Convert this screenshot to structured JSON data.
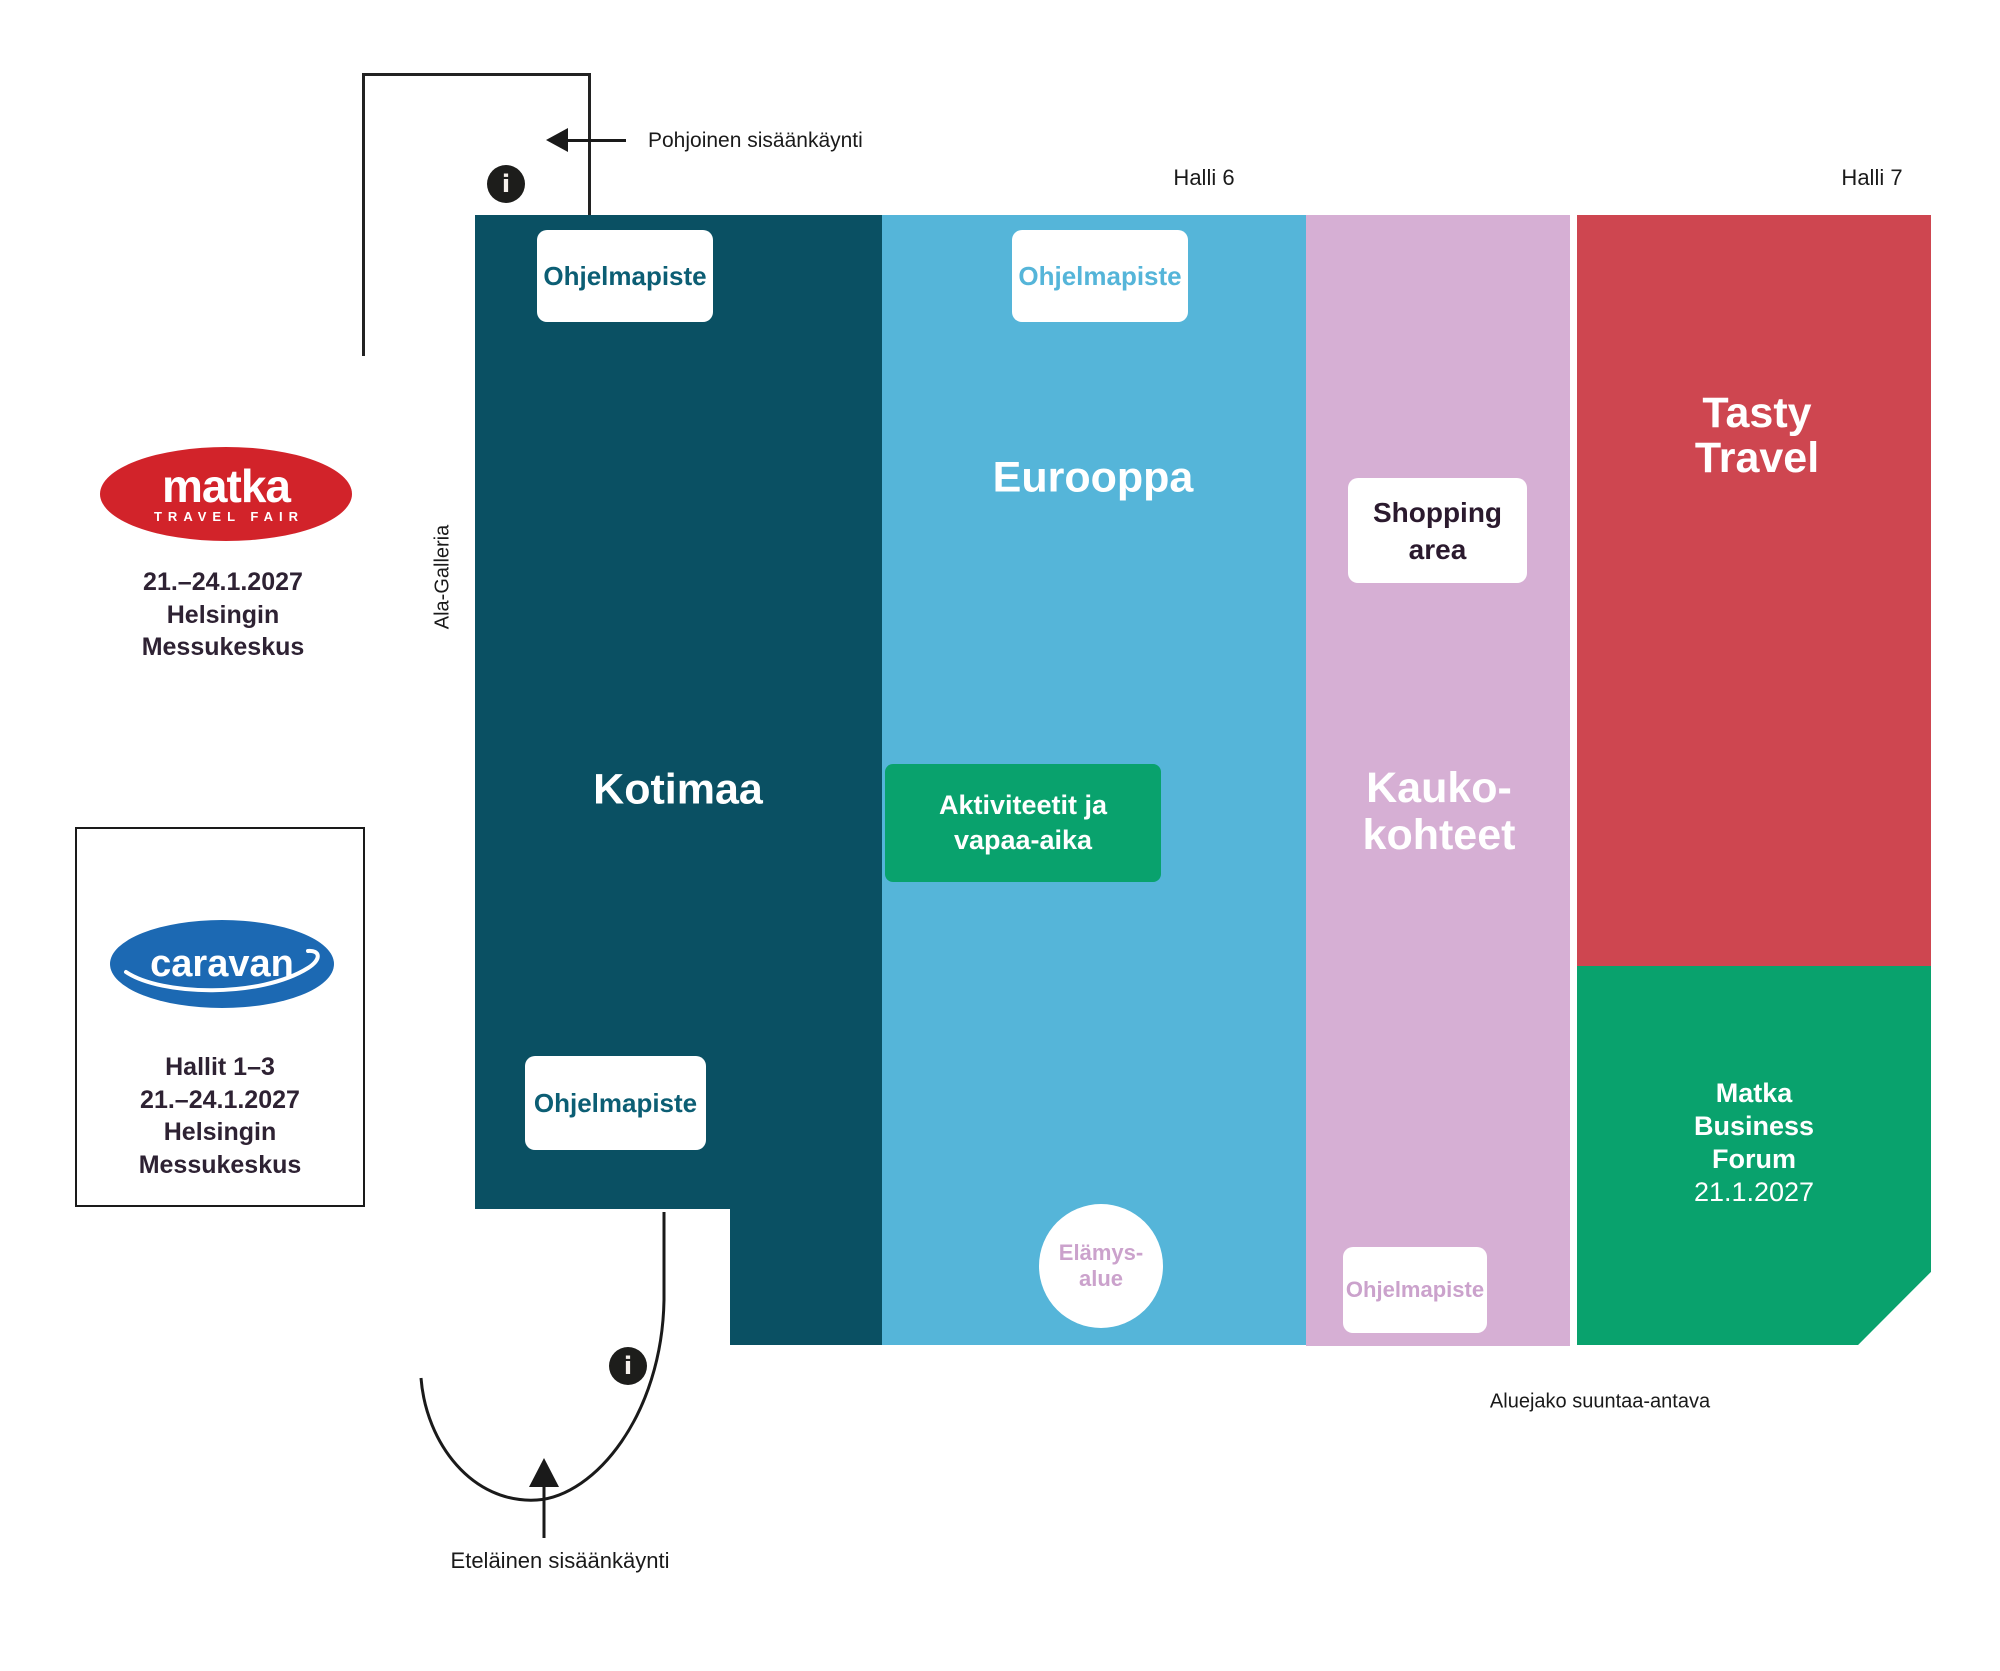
{
  "halls": {
    "halli6": "Halli 6",
    "halli7": "Halli 7"
  },
  "entrances": {
    "north": "Pohjoinen sisäänkäynti",
    "south": "Eteläinen sisäänkäynti"
  },
  "gallery_label": "Ala-Galleria",
  "footnote": "Aluejako suuntaa-antava",
  "info_icon_glyph": "i",
  "sidebar": {
    "matka": {
      "logo_text": "matka",
      "logo_tagline": "TRAVEL FAIR",
      "logo_color": "#d2232a",
      "dates": "21.–24.1.2027",
      "city": "Helsingin",
      "venue": "Messukeskus"
    },
    "caravan": {
      "logo_text": "caravan",
      "logo_color": "#1c69b3",
      "halls": "Hallit 1–3",
      "dates": "21.–24.1.2027",
      "city": "Helsingin",
      "venue": "Messukeskus"
    }
  },
  "map": {
    "regions": {
      "kotimaa": {
        "name": "Kotimaa",
        "color": "#0a5063"
      },
      "eurooppa": {
        "name": "Eurooppa",
        "color": "#55b5d9"
      },
      "kaukokohteet": {
        "name_line1": "Kauko-",
        "name_line2": "kohteet",
        "color": "#d6afd4"
      },
      "tasty_travel": {
        "name_line1": "Tasty",
        "name_line2": "Travel",
        "color": "#ce4650"
      },
      "matka_business_forum": {
        "name_line1": "Matka",
        "name_line2": "Business",
        "name_line3": "Forum",
        "date": "21.1.2027",
        "color": "#09a26d"
      }
    },
    "markers": {
      "ohjelmapiste_kotimaa_top": {
        "label": "Ohjelmapiste"
      },
      "ohjelmapiste_eurooppa": {
        "label": "Ohjelmapiste"
      },
      "ohjelmapiste_kotimaa_bottom": {
        "label": "Ohjelmapiste"
      },
      "ohjelmapiste_kaukokohteet": {
        "label": "Ohjelmapiste"
      },
      "shopping_area": {
        "line1": "Shopping",
        "line2": "area"
      },
      "elamysalue": {
        "line1": "Elämys-",
        "line2": "alue"
      },
      "aktiviteetit": {
        "line1": "Aktiviteetit ja",
        "line2": "vapaa-aika",
        "color": "#09a26d"
      }
    }
  }
}
